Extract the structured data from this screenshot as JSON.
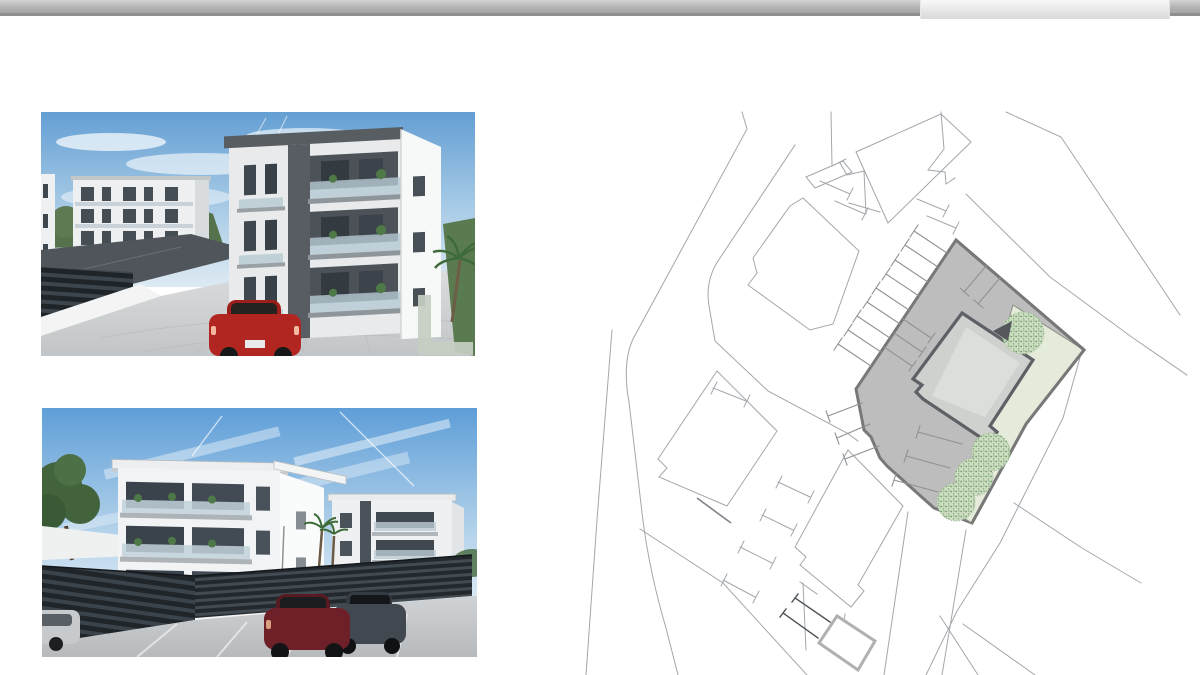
{
  "page": {
    "background": "#ffffff"
  },
  "topbar": {
    "bar_gradient_top": "#d4d4d4",
    "bar_gradient_bottom": "#a6a6a6",
    "bar_underline": "#8f8f8f",
    "tab_gradient_top": "#f8f8f8",
    "tab_gradient_bottom": "#d9d9d9"
  },
  "gallery": {
    "photos": [
      {
        "alt": "3D exterior rendering: white three-storey apartment building with dark grey balconies, paved courtyard, red car, trees and blue sky"
      },
      {
        "alt": "3D exterior rendering: two white apartment buildings behind a dark slatted fence with parked cars in front"
      }
    ],
    "watermark": {
      "shape": "L",
      "color": "#c6cec3"
    }
  },
  "site_plan": {
    "alt": "Cadastral site plan with highlighted grey parcel, building footprint, garden strip, four trees and parking stalls",
    "colors": {
      "parcel_fill": "#bdbdbd",
      "parcel_border": "#787878",
      "building_fill": "#cfd1cf",
      "building_inner": "#dcdedc",
      "building_border": "#5d6165",
      "garden_fill": "#e5ebdb",
      "tree_green": "#6f9c68",
      "thin_line": "#a3a7ab",
      "dark_line": "#4e5358",
      "shed_border": "#b0b0b0"
    }
  }
}
